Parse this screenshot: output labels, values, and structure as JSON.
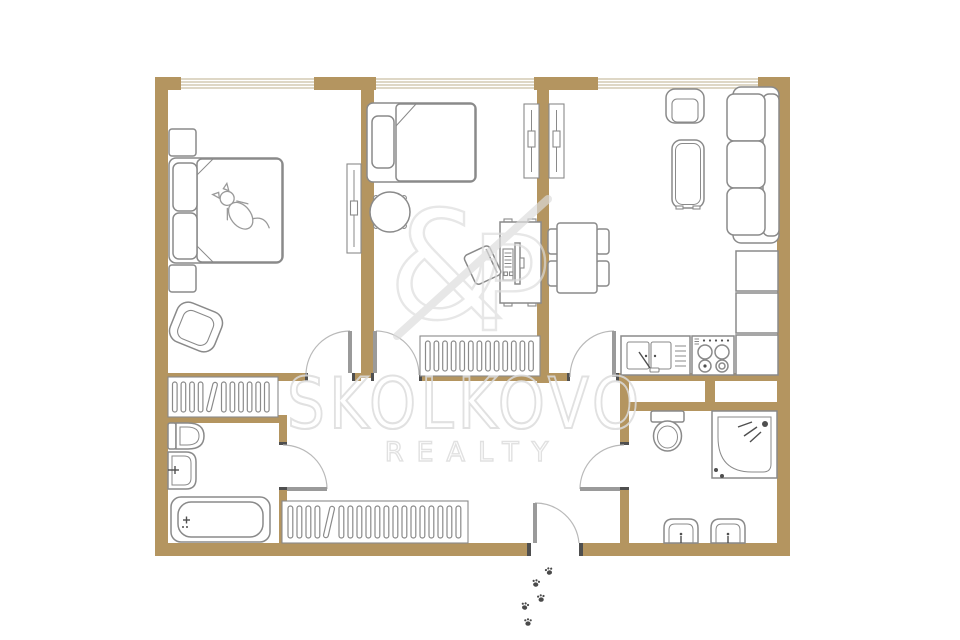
{
  "document": {
    "type": "apartment floor plan",
    "view": "top-down 2D plan with furniture, no room labels or dimensions shown"
  },
  "watermark": {
    "brand": "SKOLKOVO",
    "division": "REALTY",
    "logo": {
      "amp": "&",
      "p": "P"
    }
  },
  "colors": {
    "wall": "#b49560",
    "outline": "#8a8a8a",
    "door": "#9a9a9a",
    "cap": "#4f4f4f",
    "winline": "#cbbfa4",
    "wm": "#dcdcdc",
    "paw": "#4a4a4a",
    "bg": "#ffffff"
  },
  "plan": {
    "windows_on_top_wall": 3,
    "entrance": "door in bottom wall with paw prints leading outside",
    "rooms": [
      {
        "name": "bedroom-left",
        "furniture": [
          "double-bed with cat",
          "nightstand",
          "nightstand",
          "armchair",
          "slim-wardrobe"
        ]
      },
      {
        "name": "bedroom-middle",
        "furniture": [
          "single-bed",
          "round-table",
          "desk with monitor and keyboard",
          "desk-chair",
          "radiator",
          "slim-wardrobe"
        ]
      },
      {
        "name": "living-room-kitchen",
        "furniture": [
          "armchair",
          "coffee-table",
          "sofa",
          "dining-table",
          "4 dining-chairs",
          "kitchen-sink-cabinet",
          "stove",
          "kitchen-counter",
          "2 kitchen-cabinets",
          "slim-wardrobe"
        ]
      },
      {
        "name": "bathroom-left",
        "furniture": [
          "toilet",
          "washbasin",
          "bathtub"
        ]
      },
      {
        "name": "shower-room-right",
        "furniture": [
          "toilet",
          "corner-shower",
          "washbasin",
          "washbasin"
        ]
      },
      {
        "name": "hallway",
        "furniture": [
          "wardrobe-with-hangers",
          "long-wardrobe-with-hangers"
        ]
      }
    ],
    "interior_doors": 5,
    "paw_print_count": 5
  }
}
